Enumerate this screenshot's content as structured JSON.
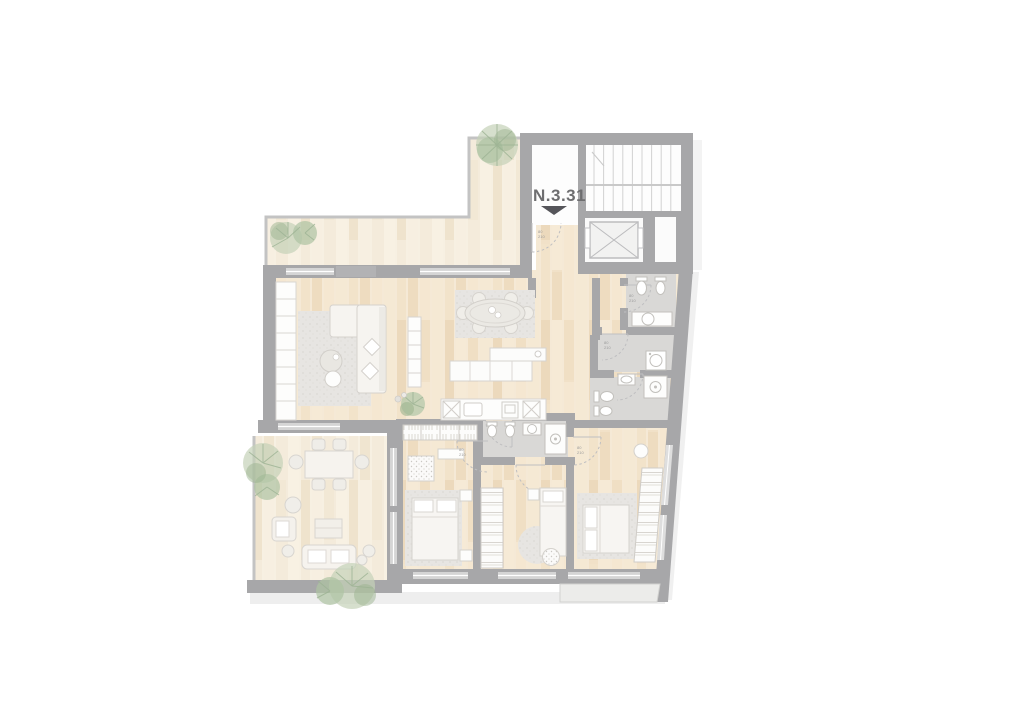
{
  "unit_label": {
    "text": "N.3.31"
  },
  "entrance_marker": {
    "icon": "down-triangle-icon",
    "color": "#55555a"
  },
  "door_mark": {
    "width_cm": "80",
    "height_cm": "210"
  },
  "palette": {
    "wall": "#a7a7a9",
    "pier": "#b2b2b4",
    "wood_floor": "#f1e1c8",
    "terrace_wood": "#f4ebdb",
    "bath_floor": "#d9d8d6",
    "window_glass": "#d5d5d5",
    "furniture_white": "#fdfdfc",
    "rug_gray": "#e7e5e2",
    "plant_green": "#a9bf9e",
    "label_gray": "#6e6e70",
    "stair_line": "#d2d2d2"
  }
}
